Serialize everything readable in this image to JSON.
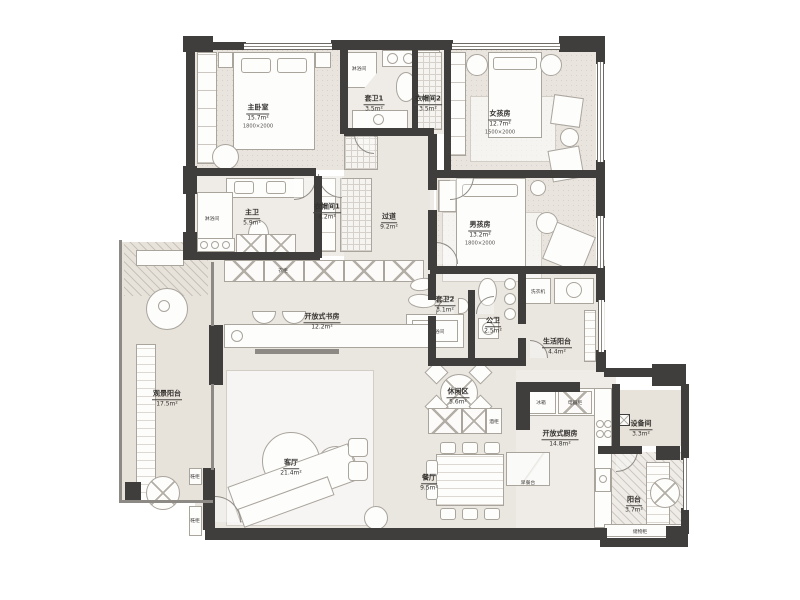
{
  "unit": "m²",
  "rooms": {
    "master_bedroom": {
      "name": "主卧室",
      "area": "15.7m²",
      "bed": "1800×2000"
    },
    "ensuite1": {
      "name": "套卫1",
      "area": "3.5m²"
    },
    "closet2": {
      "name": "衣帽间2",
      "area": "3.5m²"
    },
    "girls_room": {
      "name": "女孩房",
      "area": "12.7m²",
      "bed": "1500×2000"
    },
    "master_bath": {
      "name": "主卫",
      "area": "5.9m²"
    },
    "closet1": {
      "name": "衣帽间1",
      "area": "4.2m²"
    },
    "hallway": {
      "name": "过道",
      "area": "9.2m²"
    },
    "boys_room": {
      "name": "男孩房",
      "area": "13.2m²",
      "bed": "1800×2000"
    },
    "ensuite2": {
      "name": "套卫2",
      "area": "3.1m²"
    },
    "guest_bath": {
      "name": "公卫",
      "area": "2.5m²"
    },
    "service_balcony": {
      "name": "生活阳台",
      "area": "4.4m²"
    },
    "open_study": {
      "name": "开放式书房",
      "area": "12.2m²"
    },
    "view_balcony": {
      "name": "观景阳台",
      "area": "17.5m²"
    },
    "living_room": {
      "name": "客厅",
      "area": "21.4m²"
    },
    "leisure_area": {
      "name": "休闲区",
      "area": "5.6m²"
    },
    "dining_room": {
      "name": "餐厅",
      "area": "9.5m²"
    },
    "open_kitchen": {
      "name": "开放式厨房",
      "area": "14.8m²"
    },
    "equipment_room": {
      "name": "设备间",
      "area": "3.3m²"
    },
    "balcony": {
      "name": "阳台",
      "area": "3.7m²"
    }
  },
  "fixtures": {
    "shower_ensuite1": "淋浴间",
    "shower_master": "淋浴间",
    "shower_ensuite2": "淋浴间",
    "washer": "洗衣机",
    "fridge": "冰箱",
    "appliance_cab": "电器柜",
    "wine_cabinet": "酒柜",
    "breakfast_bar": "早餐台",
    "storage_cabinet": "储物柜",
    "shoe_cabinet_1": "鞋柜",
    "shoe_cabinet_2": "鞋柜",
    "hall_cabinet": "衣柜"
  },
  "dimensions": {
    "girls_wall": "1100"
  },
  "colors": {
    "wall": "#3f3e3c",
    "floor_beige": "#e9e4dd",
    "floor_light": "#efece7",
    "furniture": "#fdfdfc",
    "line": "#a9a49c"
  }
}
